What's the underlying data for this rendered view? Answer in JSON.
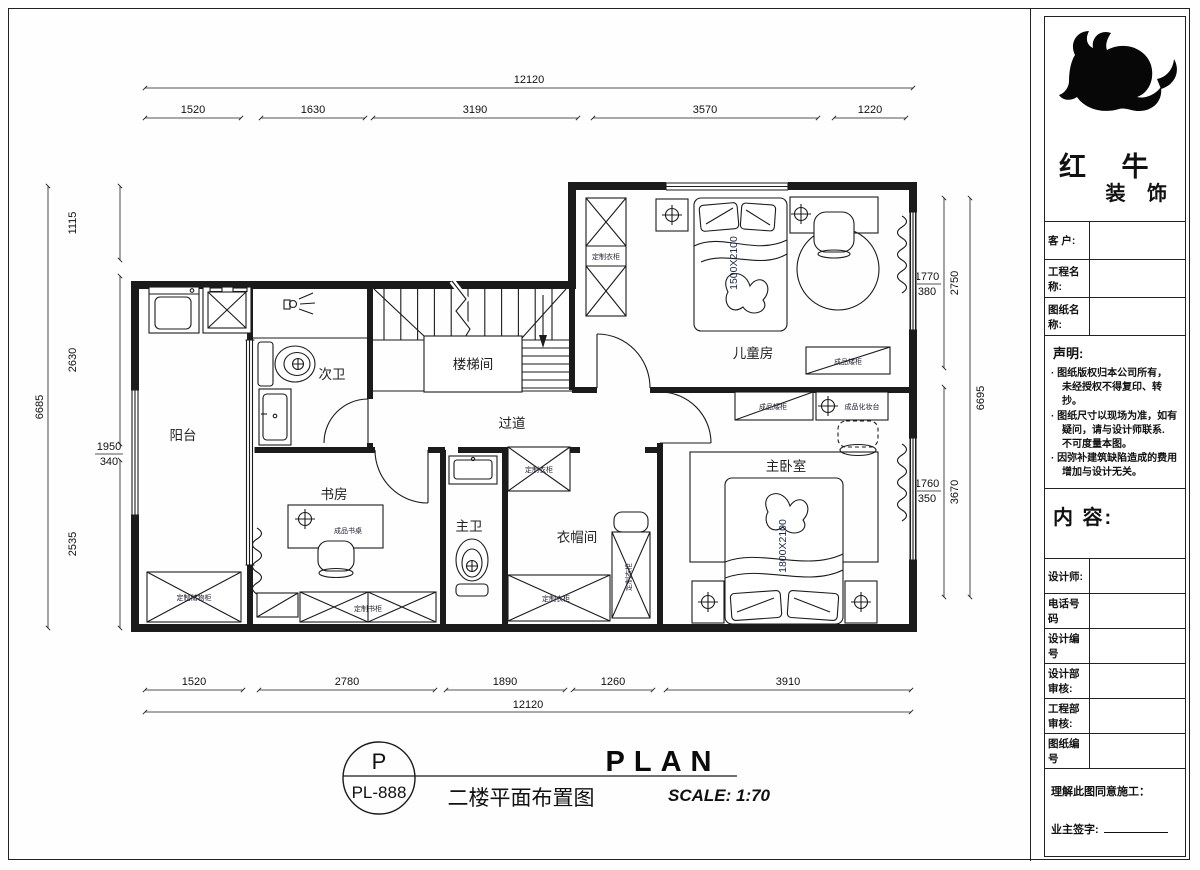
{
  "panel": {
    "logo_line1": "红 牛",
    "logo_line2": "装 饰",
    "fields": {
      "customer": "客 户:",
      "project": "工程名称:",
      "drawing": "图纸名称:"
    },
    "statement": {
      "title": "声明:",
      "lines": [
        "· 图纸版权归本公司所有，",
        "未经授权不得复印、转抄。",
        "· 图纸尺寸以现场为准，如有",
        "疑问，请与设计师联系.",
        "不可度量本图。",
        "· 因弥补建筑缺陷造成的费用",
        "增加与设计无关。"
      ]
    },
    "content_label": "内 容:",
    "rows": {
      "designer": "设计师:",
      "phone": "电话号码",
      "design_no": "设计编号",
      "design_review": "设计部审核:",
      "eng_review": "工程部审核:",
      "drawing_no": "图纸编号"
    },
    "footer": {
      "line1": "理解此图同意施工：",
      "line2": "业主签字:"
    }
  },
  "plan": {
    "rooms": {
      "balcony": "阳台",
      "bath2": "次卫",
      "stair": "楼梯间",
      "corridor": "过道",
      "kids": "儿童房",
      "master": "主卧室",
      "study": "书房",
      "bath1": "主卫",
      "cloak": "衣帽间"
    },
    "furniture": {
      "wardrobe": "定制衣柜",
      "kids_cabinet": "成品矮柜",
      "master_cabinet": "成品矮柜",
      "dresser": "成品化妆台",
      "desk": "成品书桌",
      "bookcase": "定制书柜",
      "balcony_cabinet": "定制储物柜",
      "kids_bed_size": "1500X2100",
      "master_bed_size": "1800X2100"
    }
  },
  "dims": {
    "top": {
      "overall": "12120",
      "segments": [
        "1520",
        "1630",
        "3190",
        "3570",
        "1220"
      ]
    },
    "bottom": {
      "overall": "12120",
      "segments": [
        "1520",
        "2780",
        "1890",
        "1260",
        "3910"
      ]
    },
    "left": {
      "overall": "6685",
      "segments": [
        "1115",
        "2630",
        "2535"
      ],
      "fraction_num": "1950",
      "fraction_den": "340"
    },
    "right": {
      "overall": "6695",
      "segments": [
        "2750",
        "3670"
      ],
      "fraction1_num": "1770",
      "fraction1_den": "380",
      "fraction2_num": "1760",
      "fraction2_den": "350"
    }
  },
  "title": {
    "circle_top": "P",
    "circle_bottom": "PL-888",
    "name_cn": "二楼平面布置图",
    "name_en": "PLAN",
    "scale": "SCALE: 1:70"
  }
}
